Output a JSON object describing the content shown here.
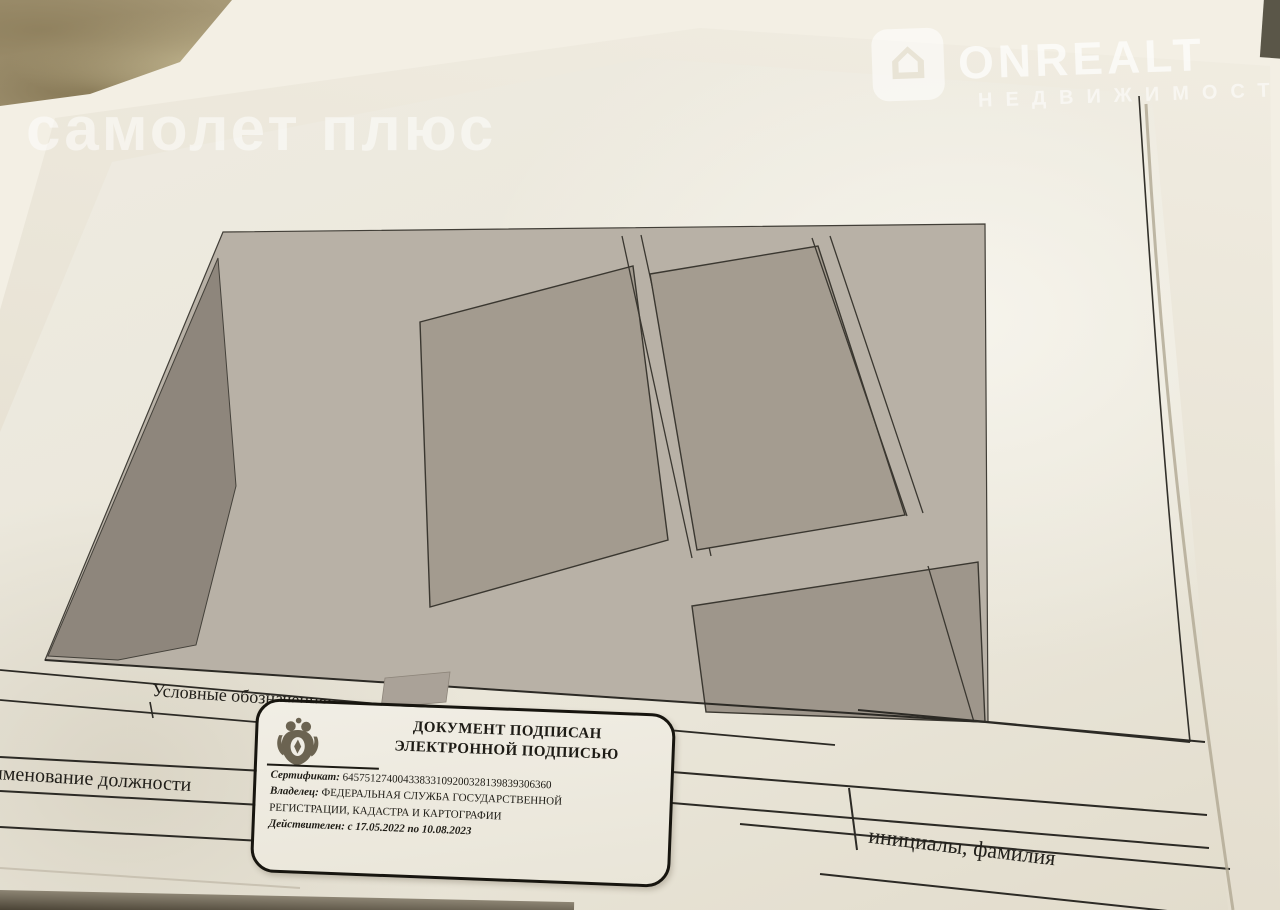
{
  "page": {
    "section_header": {
      "section": "Раздел 3",
      "sheet": "Лист 4"
    },
    "title": "Выписка из Единого государственного реестра недвижимости об основных характеристиках и зарегистрированных правах на объект недвижимости",
    "table": {
      "row_description": "Описание местоположения земельного участка",
      "object_type": "Земельный участок",
      "object_type_caption": "вид объекта недвижимости",
      "sheet_row": {
        "cells": [
          "Лист № 1 раздела 3",
          "Всего листов раздела 3: 1",
          "Всего разделов: 3",
          "Всего листов выписки: 4"
        ]
      },
      "date": "28.10.2022г.",
      "cadastral_label": "Кадастровый номер:",
      "cadastral_number": "12:05:0904001:1176",
      "plan_label": "План (чертеж, схема) земельного участка"
    },
    "plan": {
      "labels": {
        "parcel_left_partial": "54",
        "parcel_main": ":1176",
        "parcel_right": "12:05:0904001:1177/1",
        "zone": "12:05-6.15"
      }
    },
    "legend_label": "Условные обозначения:",
    "signature": {
      "position_caption": "именование должности",
      "name_caption": "инициалы, фамилия"
    },
    "stamp": {
      "line1": "ДОКУМЕНТ ПОДПИСАН",
      "line2": "ЭЛЕКТРОННОЙ ПОДПИСЬЮ",
      "certificate_label": "Сертификат:",
      "certificate_value": "64575127400433833109200328139839306360",
      "owner_label": "Владелец:",
      "owner_value": "ФЕДЕРАЛЬНАЯ СЛУЖБА ГОСУДАРСТВЕННОЙ",
      "owner_value2": "РЕГИСТРАЦИИ, КАДАСТРА И КАРТОГРАФИИ",
      "validity": "Действителен: с 17.05.2022 по 10.08.2023"
    }
  },
  "watermarks": {
    "samolet": "самолет плюс",
    "onrealt": "ONREALT",
    "onrealt_sub": "НЕДВИЖИМОСТЬ",
    "onrealt_house_icon": "⌂"
  },
  "background_text": {
    "top_words": [
      "платно",
      "2022 г.",
      "инистрации",
      "дарственной",
      "патно от",
      "министрация",
      "ия «Город",
      "ва Дмитрия",
      "инистрации",
      "принимает",
      "аграничных",
      "жое поле,"
    ],
    "right_words": [
      "турк",
      "нийх",
      "ткой",
      "ыми",
      "стью",
      "осить",
      "участке",
      "ументов,",
      "активов,"
    ]
  },
  "colors": {
    "table_surface": "#a89a77",
    "paper_main": "#eceade",
    "paper_under": "#f2eee3",
    "scan_background": "#b8b1a6",
    "parcel_gray": "#a39b8f",
    "parcel_dark": "#8e867c",
    "ink": "#23211c"
  }
}
